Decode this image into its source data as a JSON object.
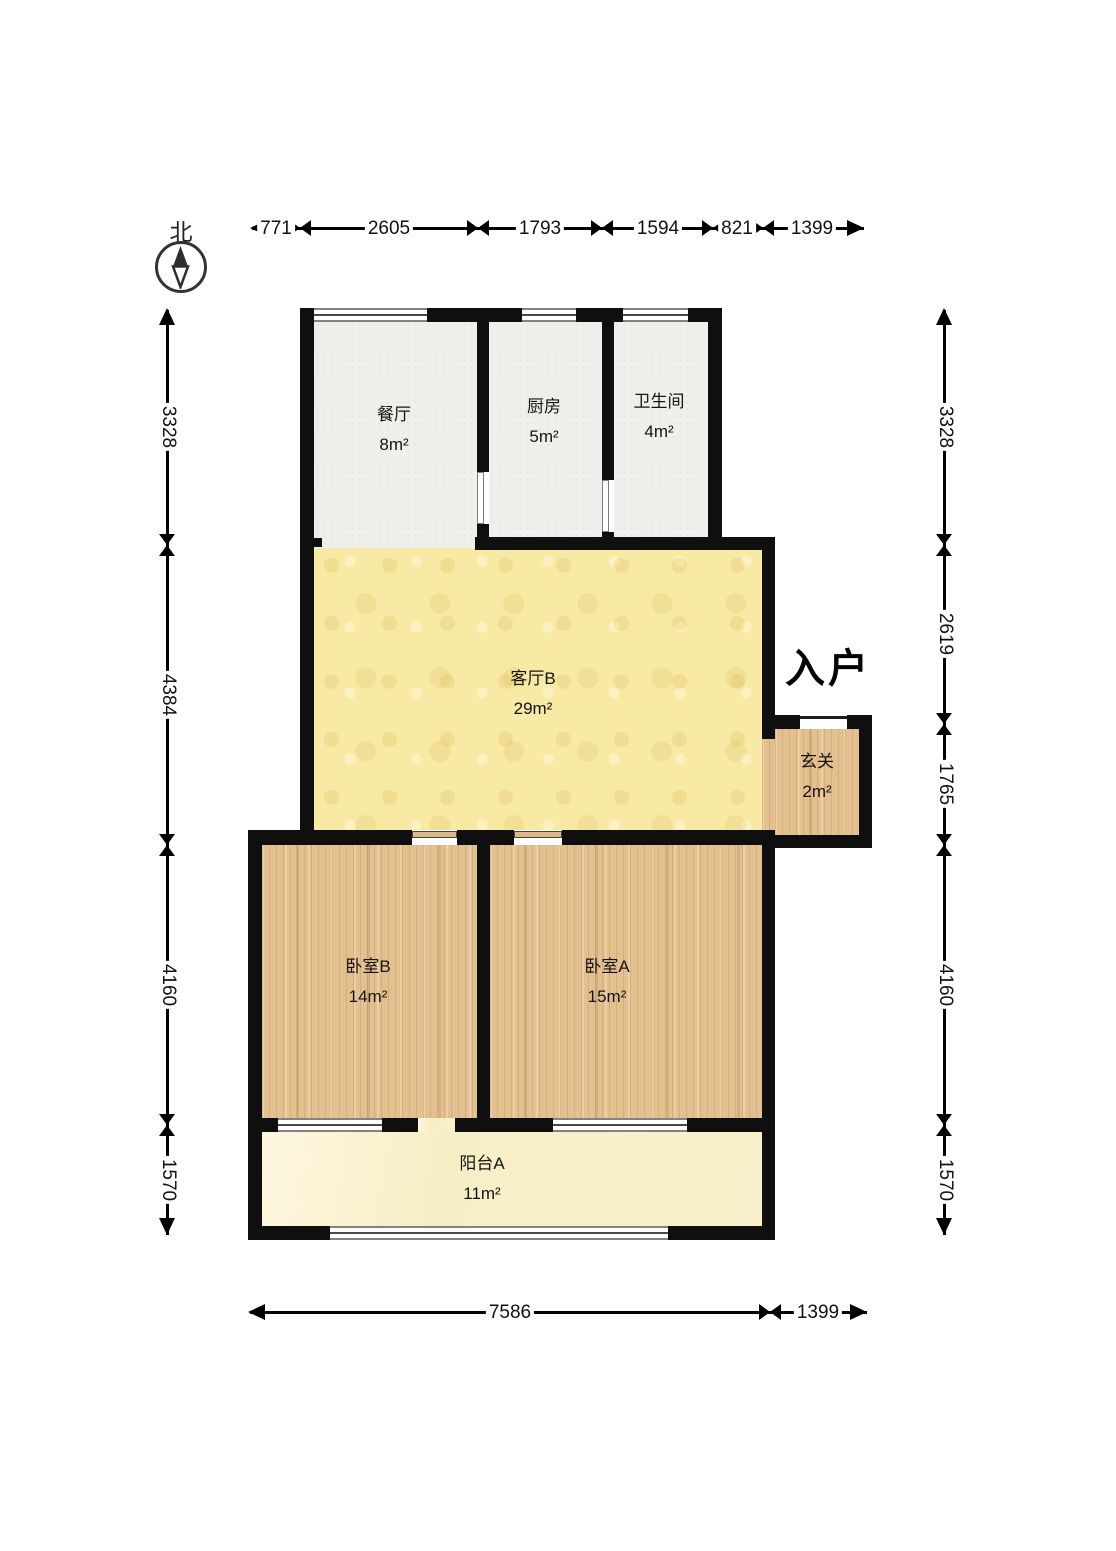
{
  "compass": {
    "north_label": "北"
  },
  "entrance": {
    "label": "入户"
  },
  "rooms": {
    "dining": {
      "name": "餐厅",
      "area": "8m²"
    },
    "kitchen": {
      "name": "厨房",
      "area": "5m²"
    },
    "bathroom": {
      "name": "卫生间",
      "area": "4m²"
    },
    "living": {
      "name": "客厅B",
      "area": "29m²"
    },
    "foyer": {
      "name": "玄关",
      "area": "2m²"
    },
    "bedroom_b": {
      "name": "卧室B",
      "area": "14m²"
    },
    "bedroom_a": {
      "name": "卧室A",
      "area": "15m²"
    },
    "balcony": {
      "name": "阳台A",
      "area": "11m²"
    }
  },
  "dimensions": {
    "top": [
      "771",
      "2605",
      "1793",
      "1594",
      "821",
      "1399"
    ],
    "left": [
      "3328",
      "4384",
      "4160",
      "1570"
    ],
    "right": [
      "3328",
      "2619",
      "1765",
      "4160",
      "1570"
    ],
    "bottom": [
      "7586",
      "1399"
    ]
  },
  "colors": {
    "wall": "#0f0f0f",
    "living_floor": "#f8e9a4",
    "wood_floor": "#e3c08f",
    "balcony_floor": "#f9f0cb",
    "tile_floor": "#f1efec",
    "window_line": "#828282",
    "dimension": "#000000"
  }
}
